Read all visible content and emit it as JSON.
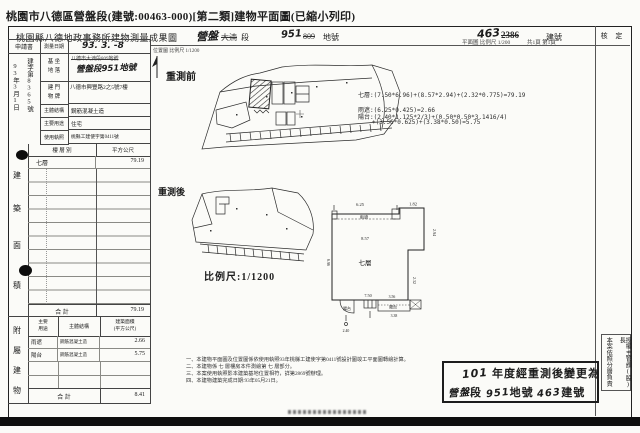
{
  "colors": {
    "paper": "#fbfbf8",
    "ink": "#1c1c1c",
    "bar": "#0e0e0e"
  },
  "title": "桃園市八德區營盤段(建號:00463-000)[第二類]建物平面圖(已縮小列印)",
  "header": {
    "office": "桃園縣八德地政事務所建物測量成果圖",
    "section_new": "營盤",
    "section_old": "大湳",
    "section_label": "段",
    "land_new": "951",
    "land_old": "809",
    "land_label": "地號",
    "building_new": "463",
    "building_old": "2386",
    "building_label": "建號",
    "plan_scale": "平面圖 比例尺 1/200",
    "pages": "共1頁 第1頁",
    "approval": "核  定"
  },
  "application": {
    "title": "申請書",
    "doc_no": "建字第8365號",
    "date": "93年3月1日"
  },
  "fields": {
    "survey_date_label": "測量日期",
    "survey_date": "93. 3. -8",
    "site_label_1": "基 坐",
    "site_label_2": "地 落",
    "site_old": "八德市大湳段809地號",
    "site_new": "營盤段951地號",
    "address_label_1": "建 門",
    "address_label_2": "物 牌",
    "address": "八德市興豐路2之5號7樓",
    "structure_label": "主體結構",
    "structure": "鋼筋混凝土造",
    "use_label": "主要用途",
    "use": "住宅",
    "license_label": "使用執照",
    "license": "桃縣工建使字第0411號"
  },
  "floor_area": {
    "side": [
      "建",
      "築",
      "面",
      "積"
    ],
    "col_floor": "樓 層 別",
    "col_area": "平方公尺",
    "row_floor": "七層",
    "row_area": "79.19",
    "total_label": "合  計",
    "total": "79.19"
  },
  "attached": {
    "side": [
      "附",
      "屬",
      "建",
      "物"
    ],
    "col_use_1": "主要",
    "col_use_2": "用途",
    "col_structure": "主體結構",
    "col_area_1": "建築面積",
    "col_area_2": "(平方公尺)",
    "rows": [
      {
        "use": "雨遮",
        "structure": "鋼筋混凝土造",
        "area": "2.66"
      },
      {
        "use": "陽台",
        "structure": "鋼筋混凝土造",
        "area": "5.75"
      }
    ],
    "total_label": "合  計",
    "total": "8.41"
  },
  "maps": {
    "location_caption": "位置圖 比例尺 1/1200",
    "before": "重測前",
    "after": "重測後",
    "after_scale": "比例尺:1/1200"
  },
  "formulas": {
    "floor7": "七層:(7.50*6.96)+(8.57*2.94)+(2.32*0.775)=79.19",
    "canopy": "雨遮:(6.25*0.425)=2.66",
    "balcony1": "陽台:(2.40*1.125*2/3)+(0.50*0.50*3.1416/4)",
    "balcony2": "+(3.56*0.625)+(3.38*0.50)=5.75"
  },
  "plan": {
    "canopy": "雨遮",
    "floor": "七層",
    "balcony_l": "陽台",
    "balcony_r": "陽台",
    "dim_top": "6.25",
    "dim_top_right": "1.82",
    "dim_right": "2.94",
    "dim_left": "6.96",
    "dim_inner": "8.57",
    "dim_bottom": "7.50",
    "dim_bl": "2.40",
    "dim_br1": "3.56",
    "dim_br2": "3.38",
    "dim_step": "2.32"
  },
  "notes": [
    "一、本建物平面圖及位置圖係依使用執照93年桃縣工建使字第0411號設計圖竣工平面圖轉繪計算。",
    "二、本建物係 七 層樓房本件測繪第 七 層部分。",
    "三、本案使用執照影本建築基地位置相符，詳第2869號辦理。",
    "四、本建物建築完成日期:93年05月21日。"
  ],
  "restamp": {
    "year": "101",
    "line1_text": "年度經重測後變更為",
    "sec": "營盤",
    "sec_label": "段",
    "land": "951",
    "land_label": "地號",
    "bldg": "463",
    "bldg_label": "建號"
  },
  "delegation": {
    "col_right": "授權主管課(股)長",
    "col_left": "本案依照分層負責"
  }
}
